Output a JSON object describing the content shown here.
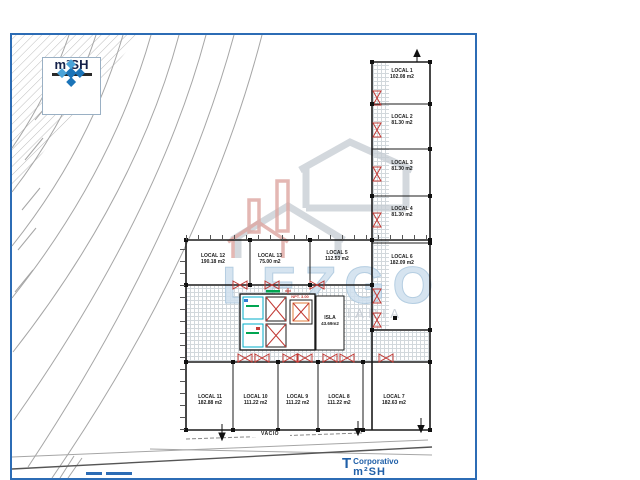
{
  "logo": {
    "brand": "m²SH"
  },
  "watermark": {
    "brand": "LEZGO",
    "subtitle": "INMOBILIARIA"
  },
  "footer": {
    "company": "Corporativo",
    "brand": "m²SH"
  },
  "plan": {
    "vacio": "VACIO",
    "core": {
      "isla": "ISLA",
      "isla_area": "43.69m2",
      "npt": "NPT. 3.00"
    },
    "locals": [
      {
        "name": "LOCAL 1",
        "area": "102.08 m2"
      },
      {
        "name": "LOCAL 2",
        "area": "81.30 m2"
      },
      {
        "name": "LOCAL 3",
        "area": "81.30 m2"
      },
      {
        "name": "LOCAL 4",
        "area": "81.30 m2"
      },
      {
        "name": "LOCAL 5",
        "area": "112.53 m2"
      },
      {
        "name": "LOCAL 6",
        "area": "182.09 m2"
      },
      {
        "name": "LOCAL 7",
        "area": "182.63 m2"
      },
      {
        "name": "LOCAL 8",
        "area": "111.22 m2"
      },
      {
        "name": "LOCAL 9",
        "area": "111.22 m2"
      },
      {
        "name": "LOCAL 10",
        "area": "111.22 m2"
      },
      {
        "name": "LOCAL 11",
        "area": "182.88 m2"
      },
      {
        "name": "LOCAL 12",
        "area": "190.18 m2"
      },
      {
        "name": "LOCAL 13",
        "area": "75.00 m2"
      }
    ]
  },
  "colors": {
    "frame_blue": "#2c6cb5",
    "plan_black": "#1b1b1b",
    "door_red": "#c23b36",
    "wc_cyan": "#00aeca",
    "wc_green": "#00a651",
    "watermark_gray": "#c6ccd3",
    "watermark_blue": "#cddfed",
    "watermark_red": "#d89790"
  }
}
